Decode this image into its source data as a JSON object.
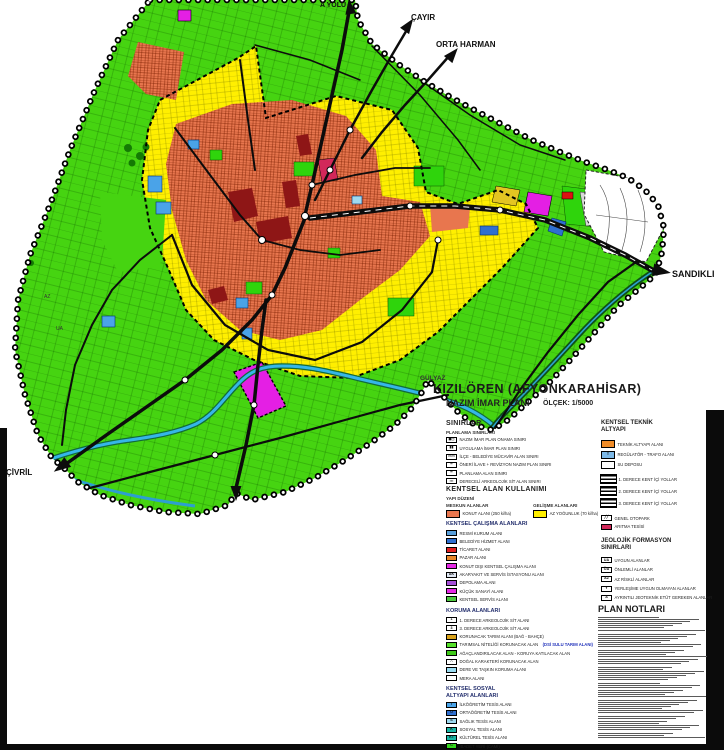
{
  "title_block": {
    "title": "KIZILÖREN (AFYONKARAHİSAR)",
    "subtitle": "NAZIM İMAR PLANI",
    "scale_label": "ÖLÇEK: 1/5000"
  },
  "map_labels": {
    "top_road": "A YOLU",
    "cayir": "ÇAYIR",
    "orta_harman": "ORTA HARMAN",
    "sandikli": "SANDIKLI",
    "civril": "ÇİVRİL",
    "gulyaz": "GÜLYAZ",
    "geo_ua": "UA",
    "geo_az": "AZ"
  },
  "colors": {
    "agriculture_green": "#46d411",
    "development_yellow": "#ffef00",
    "settlement_orange": "#e8764e",
    "center_maroon": "#8e1616",
    "water_blue": "#35b6e8",
    "road_black": "#0c0c0c",
    "magenta": "#e41fe4"
  },
  "legend": {
    "sinirlar": {
      "title": "SINIRLAR",
      "subtitle": "PLANLAMA SINIRLARI",
      "items": [
        {
          "sym": "◼◻",
          "color": "#ffffff",
          "label": "NAZIM İMAR PLAN ONAMA SINIRI"
        },
        {
          "sym": "▮▮",
          "color": "#ffffff",
          "label": "UYGULAMA İMAR PLAN SINIRI"
        },
        {
          "sym": "▭▭",
          "color": "#ffffff",
          "label": "İLÇE - BELEDİYE MÜCAVİR ALAN SINIRI"
        },
        {
          "sym": "┅",
          "color": "#ffffff",
          "label": "ÖNERİ İLAVE + REVİZYON NAZIM PLAN SINIRI"
        },
        {
          "sym": "━",
          "color": "#ffffff",
          "label": "PLANLAMA ALAN SINIRI"
        },
        {
          "sym": "▪▪▪",
          "color": "#ffffff",
          "label": "DERECELİ ARKEOLOJİK SİT ALAN SINIRI"
        }
      ]
    },
    "kullanimi": {
      "title": "KENTSEL ALAN KULLANIMI",
      "subtitle": "YAPI DÜZENİ",
      "meskun_header": "MESKUN ALANLAR",
      "gelisme_header": "GELİŞME ALANLARI",
      "meskun": {
        "color": "#e8764e",
        "label": "KONUT ALANI (250 ki/ha)"
      },
      "gelisme": {
        "color": "#ffef00",
        "label": "AZ YOĞUNLUK (70 ki/ha)"
      }
    },
    "calisma": {
      "title": "KENTSEL ÇALIŞMA ALANLARI",
      "items": [
        {
          "color": "#5aa0dc",
          "label": "RESMİ KURUM ALANI"
        },
        {
          "color": "#2f6fd0",
          "label": "BELEDİYE HİZMET ALANI"
        },
        {
          "color": "#e02020",
          "label": "TİCARET ALANI"
        },
        {
          "color": "#e8872a",
          "label": "PAZAR ALANI"
        },
        {
          "color": "#e428e4",
          "label": "KONUT DIŞI KENTSEL ÇALIŞMA ALANI"
        },
        {
          "color": "#dfe6f2",
          "sym": "AK",
          "label": "AKARYAKIT VE SERVİS İSTASYONU ALANI"
        },
        {
          "color": "#a44fd8",
          "label": "DEPOLAMA ALANI"
        },
        {
          "color": "#e428e4",
          "label": "KÜÇÜK SANAYİ ALANI"
        },
        {
          "color": "#4cc93f",
          "label": "KENTSEL SERVİS ALANI"
        }
      ]
    },
    "koruma": {
      "title": "KORUMA ALANLARI",
      "items": [
        {
          "color": "#ffffff",
          "sym": "1",
          "label": "1. DERECE ARKEOLOJİK SİT ALANI"
        },
        {
          "color": "#ffffff",
          "sym": "3",
          "label": "3. DERECE ARKEOLOJİK SİT ALANI"
        },
        {
          "color": "#d9a21b",
          "label": "KORUNACAK TARIM ALANI (BAĞ - BAHÇE)"
        },
        {
          "color": "#55e02a",
          "label": "TARIMSAL NİTELİĞİ KORUNACAK ALAN",
          "extra": "(DSİ SULU TARIM ALANI)"
        },
        {
          "color": "#3fca1a",
          "label": "AĞAÇLANDIRILACAK ALAN - KORUYA KATILACAK ALAN"
        },
        {
          "color": "#ffffff",
          "sym": "∴",
          "label": "DOĞAL KARAKTERİ KORUNACAK ALAN"
        },
        {
          "color": "#9adcf2",
          "label": "DERE VE TAŞKIN KORUMA ALANI"
        },
        {
          "color": "#ffffff",
          "label": "MERA ALANI"
        }
      ]
    },
    "sosyal": {
      "title": "KENTSEL SOSYAL",
      "title2": "ALTYAPI ALANLARI",
      "items": [
        {
          "color": "#4aa3e8",
          "sym": "İ",
          "label": "İLKÖĞRETİM TESİS ALANI"
        },
        {
          "color": "#2f6fd0",
          "sym": "O",
          "label": "ORTAÖĞRETİM TESİS ALANI"
        },
        {
          "color": "#9fd9f0",
          "sym": "S",
          "label": "SAĞLIK TESİS ALANI"
        },
        {
          "color": "#19b7a6",
          "sym": "K",
          "label": "SOSYAL TESİS ALANI"
        },
        {
          "color": "#19b7a6",
          "sym": "KT",
          "label": "KÜLTÜREL TESİS ALANI"
        },
        {
          "color": "#35d51e",
          "sym": "C",
          "label": "İBADET YERİ (CAMİ)"
        }
      ]
    },
    "teknik": {
      "title": "KENTSEL TEKNİK",
      "title2": "ALTYAPI",
      "items": [
        {
          "color": "#f08c28",
          "label": "TEKNİK ALTYAPI ALANI"
        },
        {
          "color": "#7db9e8",
          "sym": "T",
          "label": "REGÜLATÖR - TRAFO ALANI"
        },
        {
          "color": "#ffffff",
          "label": "SU DEPOSU"
        }
      ],
      "roads": [
        {
          "label": "1. DERECE KENT İÇİ YOLLAR"
        },
        {
          "label": "2. DERECE KENT İÇİ YOLLAR"
        },
        {
          "label": "3. DERECE KENT İÇİ YOLLAR"
        }
      ],
      "items2": [
        {
          "color": "#ffffff",
          "sym": "╱╱",
          "label": "GENEL OTOPARK"
        },
        {
          "color": "#d2285a",
          "label": "ARITMA TESİSİ"
        }
      ]
    },
    "jeolojik": {
      "title": "JEOLOJİK FORMASYON",
      "title2": "SINIRLARI",
      "items": [
        {
          "color": "#ffffff",
          "sym": "UA",
          "label": "UYGUN ALANLAR"
        },
        {
          "color": "#ffffff",
          "sym": "ÖA",
          "label": "ÖNLEMLİ ALANLAR"
        },
        {
          "color": "#ffffff",
          "sym": "AZ",
          "label": "AZ RİSKLİ ALANLAR"
        },
        {
          "color": "#ffffff",
          "sym": "Y",
          "label": "YERLEŞİME UYGUN OLMAYAN ALANLAR"
        },
        {
          "color": "#ffffff",
          "sym": "A",
          "label": "AYRINTILI JEOTEKNİK ETÜT GEREKEN ALANLAR"
        }
      ]
    },
    "plan_notlari": {
      "title": "PLAN NOTLARI"
    }
  }
}
